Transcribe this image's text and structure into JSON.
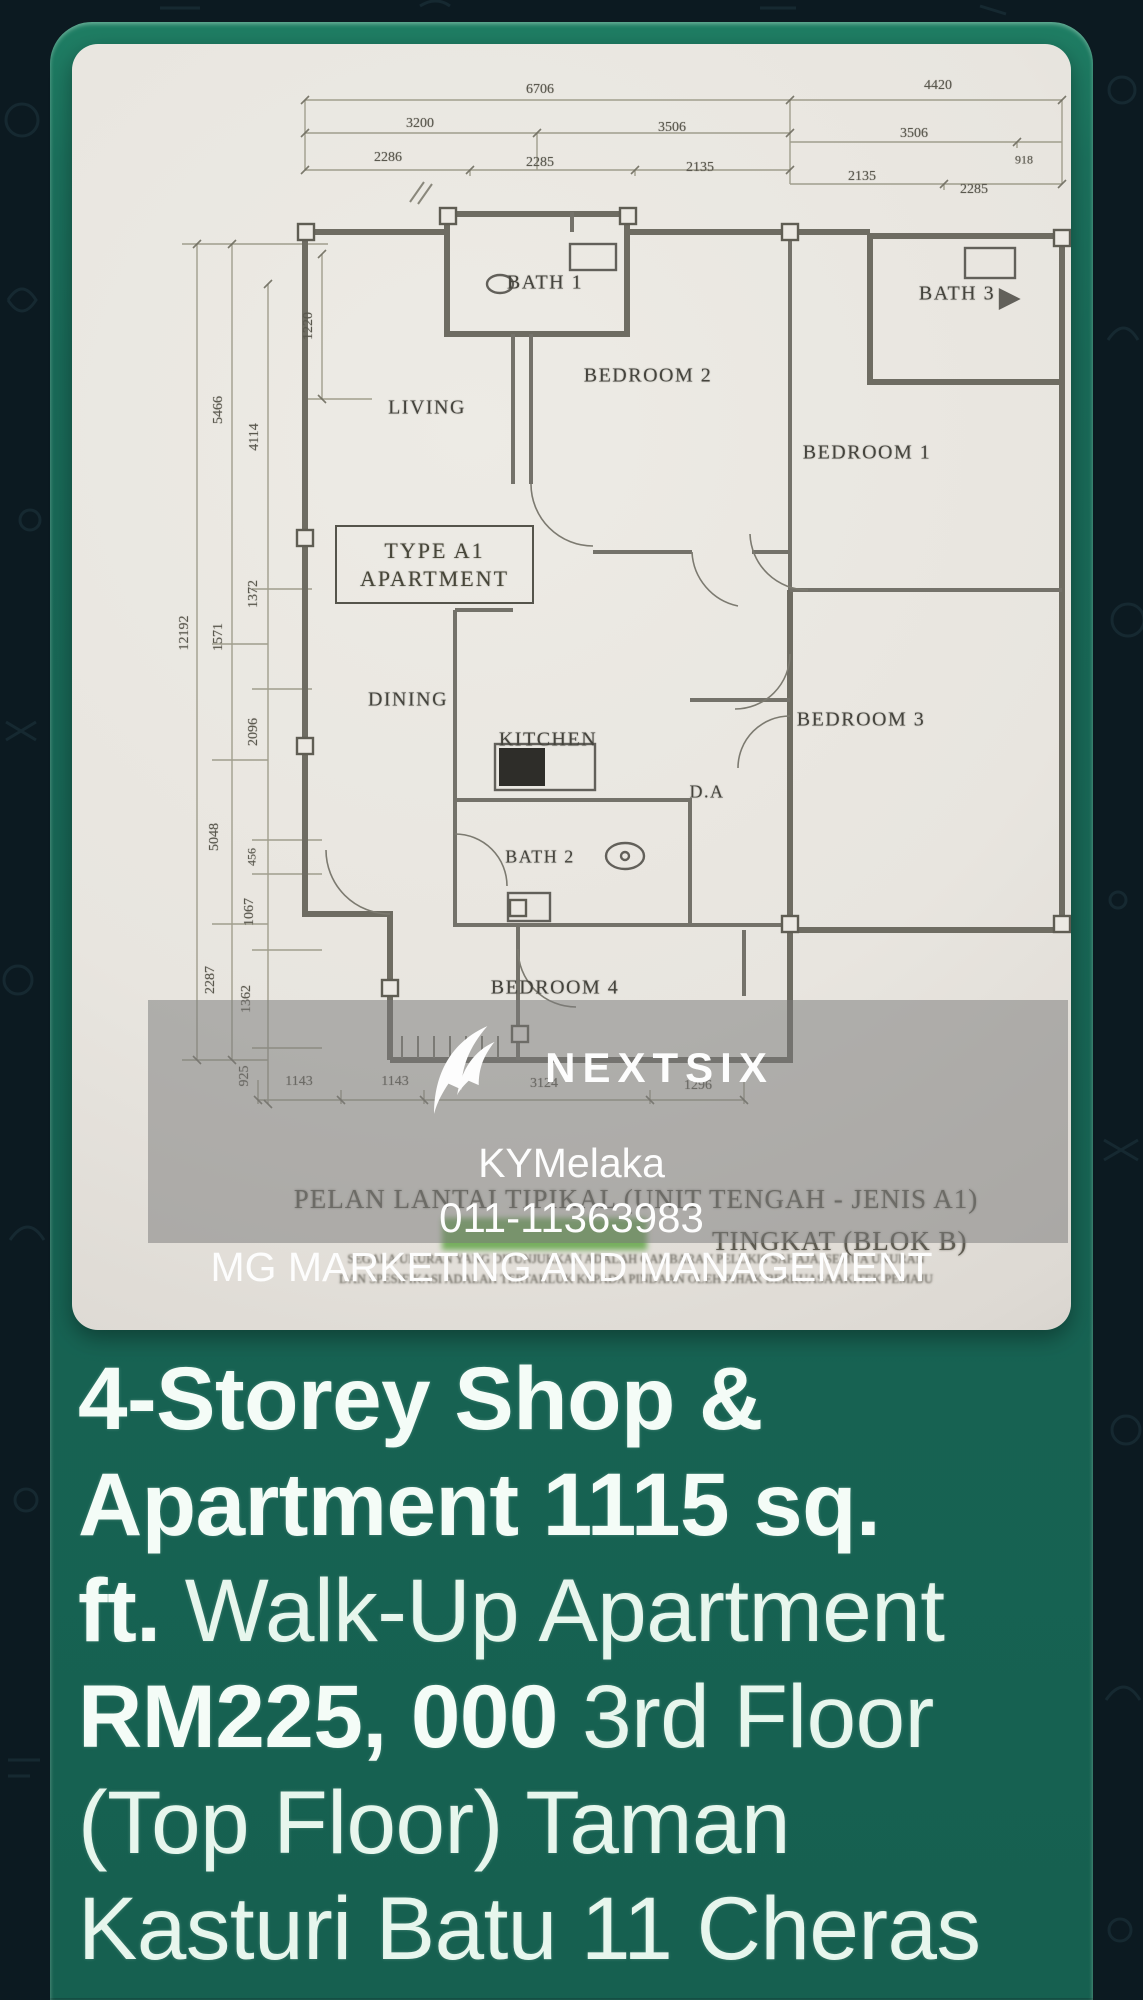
{
  "colors": {
    "background": "#0c1a21",
    "card_green": "#196a58",
    "frame_highlight": "#cdf0dc",
    "paper": "#e8e5df",
    "plan_ink": "#6e6c64",
    "watermark_overlay_gray": "#7a7a7a",
    "caption_highlight_green": "#5aa23f",
    "listing_text": "#e7f6ed"
  },
  "watermark": {
    "brand": "NEXTSIX",
    "brand_mark": "double-chevron-swoosh-icon",
    "agent": "KYMelaka",
    "phone": "011-11363983",
    "agency": "MG MARKETING AND MANAGEMENT"
  },
  "plan": {
    "unit_box": {
      "line1": "TYPE A1",
      "line2": "APARTMENT"
    },
    "rooms": [
      "BATH 1",
      "BATH 3",
      "BEDROOM 2",
      "BEDROOM 1",
      "LIVING",
      "DINING",
      "KITCHEN",
      "D.A",
      "BEDROOM 3",
      "BATH 2",
      "BEDROOM 4"
    ],
    "dims": {
      "top": [
        "6706",
        "4420",
        "3200",
        "3506",
        "3506",
        "918",
        "2286",
        "2285",
        "2135",
        "2135",
        "2285"
      ],
      "left": [
        "12192",
        "5466",
        "1571",
        "5048",
        "2287",
        "4114",
        "1372",
        "2096",
        "456",
        "1067",
        "1362",
        "925",
        "1220"
      ],
      "bottom": [
        "1143",
        "1143",
        "3124",
        "1296"
      ]
    },
    "caption": {
      "line1": "PELAN LANTAI TIPIKAL (UNIT TENGAH - JENIS A1)",
      "line2": "TINGKAT (BLOK B)",
      "disclaimer1": "SEGALA UKURAN YANG DITUNJUKKAN ADALAH GAMBARAN PELUKIS SAHAJA, SEMUA UKURAN",
      "disclaimer2": "DAN SPESIFIKASI ADALAH TERTAKLUK KEPADA PINDAAN OLEH PIHAK BERKUASA AKITEK PEMAJU"
    }
  },
  "listing": {
    "lines": [
      {
        "segments": [
          {
            "text": "4-Storey Shop &",
            "bold": true
          }
        ]
      },
      {
        "segments": [
          {
            "text": "Apartment 1115 sq.",
            "bold": true
          }
        ]
      },
      {
        "segments": [
          {
            "text": "ft.",
            "bold": true
          },
          {
            "text": " Walk-Up Apartment",
            "bold": false
          }
        ]
      },
      {
        "segments": [
          {
            "text": "RM225, 000",
            "bold": true
          },
          {
            "text": " 3rd Floor",
            "bold": false
          }
        ]
      },
      {
        "segments": [
          {
            "text": "(Top Floor) Taman",
            "bold": false
          }
        ]
      },
      {
        "segments": [
          {
            "text": "Kasturi Batu 11 Cheras",
            "bold": false
          }
        ]
      }
    ]
  }
}
